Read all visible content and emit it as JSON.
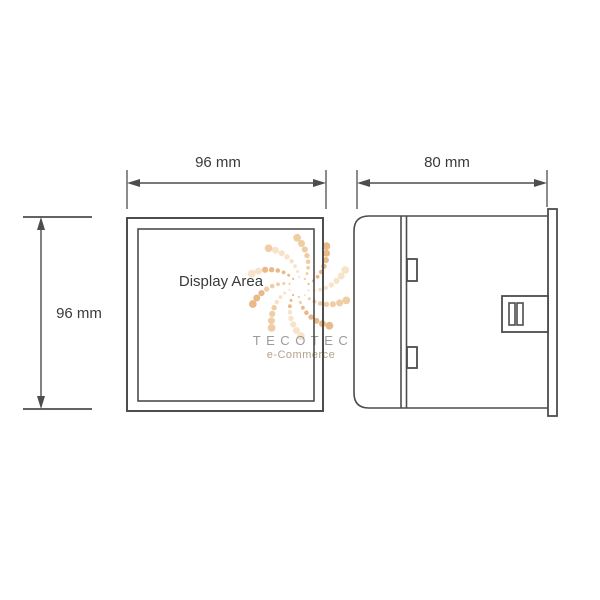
{
  "diagram": {
    "type": "panel-meter-dimension-drawing",
    "front_view": {
      "display_label": "Display Area",
      "width_dimension": {
        "label": "96 mm",
        "value": 96,
        "unit": "mm"
      },
      "height_dimension": {
        "label": "96 mm",
        "value": 96,
        "unit": "mm"
      }
    },
    "side_view": {
      "depth_dimension": {
        "label": "80 mm",
        "value": 80,
        "unit": "mm"
      }
    }
  },
  "watermark": {
    "brand": "TECOTEC",
    "tagline": "e-Commerce",
    "brand_color": "#9b9b9b",
    "tagline_color": "#b3a28c",
    "dot_colors": [
      "#f7e3c9",
      "#f0cda4",
      "#e9b988"
    ]
  },
  "colors": {
    "line": "#4d4d4d",
    "text": "#3a3a3a",
    "background": "#ffffff"
  }
}
